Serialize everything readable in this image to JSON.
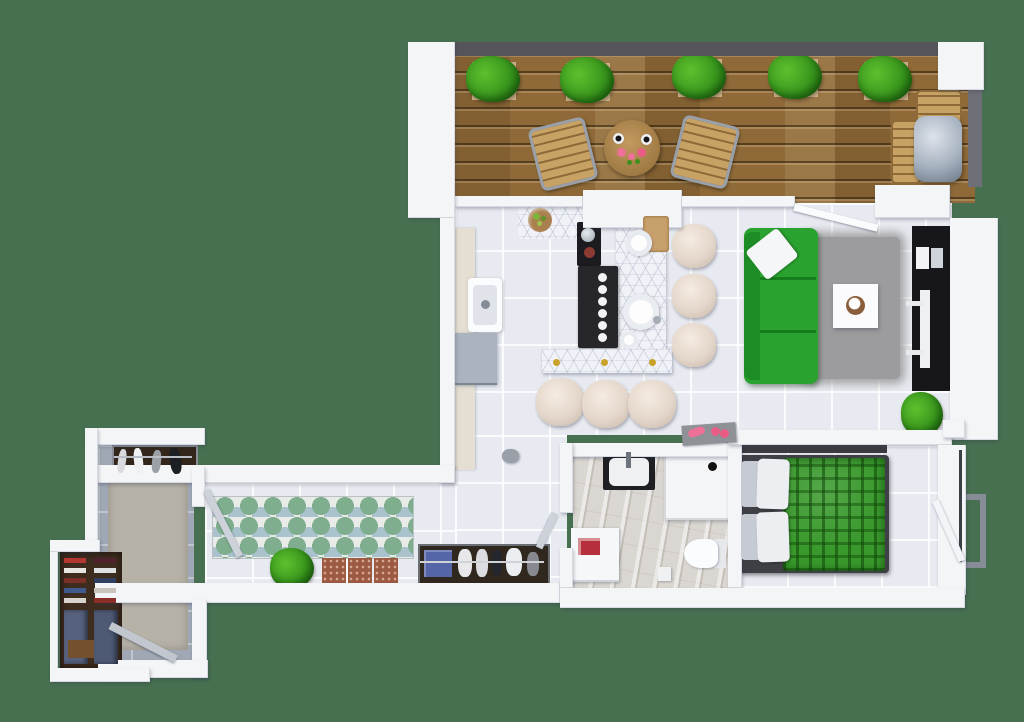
{
  "scene": {
    "type": "3d-rendered-floor-plan",
    "view": "top-down",
    "description": "One-bedroom apartment 3D floor plan with wooden terrace, open kitchen / living room, bathroom, bedroom, long hallway and entry wardrobe room"
  },
  "palette": {
    "background": "#477050",
    "wall": "#f4f5f7",
    "rail_dark": "#54545a",
    "wood_deck_light": "#8f6a38",
    "tile_floor": "#e8eaf1",
    "marble_floor": "#dad6d1",
    "entry_floor": "#9fa8b4",
    "counter_cream": "#e4dfd2",
    "appliance_gray": "#aab3bf",
    "island_white": "#f0f2f7",
    "cooktop_black": "#26262b",
    "stool_cream": "#e3d5c9",
    "sofa_green": "#29a22f",
    "sofa_green_dark": "#1d8c24",
    "rug_gray": "#9c9c9e",
    "tv_black": "#16161b",
    "bed_frame": "#3f3f46",
    "blanket_green": "#39992c",
    "pillow_white": "#eceef2",
    "plant_green": "#5ec02e",
    "plant_green_dark": "#35921b",
    "planter_tan": "#cbb089",
    "chair_wood": "#c7a264",
    "chair_metal": "#99a0aa",
    "grill_silver": "#a8b3c1",
    "runner_bg": "#e8ebe7",
    "runner_green": "#7fae8e",
    "runner_blue": "#a9c2cc",
    "mat_red": "#9c5a42",
    "bench_dark": "#30271e",
    "towel_blue": "#5465a8",
    "detergent_red": "#b5303c",
    "pink_accent": "#ee7096",
    "wardrobe_brown": "#3e2c1e",
    "denim_blue": "#56617d",
    "glass_gray": "#878d96"
  },
  "rooms": {
    "terrace": {
      "label": "terrace",
      "floor": "wood planks",
      "furniture": [
        "planter-box",
        "planter-box",
        "planter-box",
        "planter-box",
        "planter-box",
        "bistro-chair",
        "bistro-chair",
        "round-table-with-cups-and-flowers",
        "bbq-grill-with-side-tables"
      ]
    },
    "kitchen": {
      "label": "kitchen",
      "floor": "white tile",
      "furniture": [
        "wall-counter",
        "sink",
        "dishwasher",
        "fruit-bowl-counter",
        "coffee-machine",
        "cooktop-island",
        "round-island-sink",
        "breakfast-bar",
        "bar-stool",
        "bar-stool",
        "bar-stool",
        "bar-stool",
        "bar-stool",
        "bar-stool"
      ]
    },
    "living_room": {
      "label": "living room",
      "floor": "white tile",
      "furniture": [
        "green-sofa",
        "white-pillow",
        "gray-shag-rug",
        "coffee-table",
        "tv-console",
        "tv",
        "potted-plant",
        "fitness-mat-with-pink-dumbbells"
      ]
    },
    "bathroom": {
      "label": "bathroom",
      "floor": "marble",
      "furniture": [
        "vanity-sink",
        "shower",
        "toilet",
        "washing-machine",
        "detergent-box",
        "waste-bin"
      ]
    },
    "bedroom": {
      "label": "bedroom",
      "floor": "white tile",
      "furniture": [
        "double-bed-green-plaid",
        "pillows",
        "headboard-shelf",
        "open-door",
        "french-window-rail"
      ]
    },
    "hallway": {
      "label": "hallway",
      "floor": "white tile",
      "furniture": [
        "scallop-runner-rug",
        "potted-plant",
        "doormat",
        "doormat",
        "doormat",
        "shoe-bench-with-shoes",
        "open-door"
      ]
    },
    "entry": {
      "label": "entry / wardrobe",
      "floor": "gray tile",
      "furniture": [
        "shoe-rack",
        "area-rug",
        "wardrobe-shelves",
        "hanging-clothes",
        "entrance-door"
      ]
    }
  }
}
